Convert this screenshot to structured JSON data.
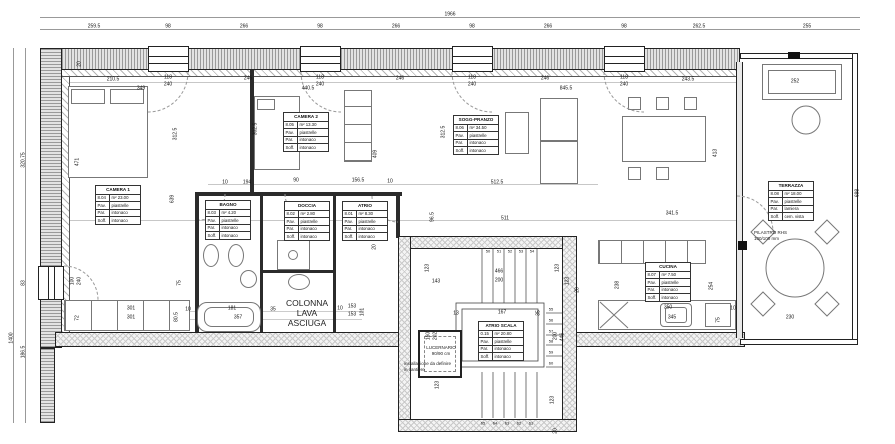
{
  "labels": {
    "m2": "m²",
    "pav": "Pav.",
    "par": "Par.",
    "soff": "Soff."
  },
  "colors": {
    "wall_line": "#222222",
    "hatch": "#9a9a9a",
    "dim_text": "#111111"
  },
  "rooms": [
    {
      "name": "CAMERA 1",
      "code": "8.04",
      "area": "23.00",
      "pav": "piastrelle",
      "par": "intonaco",
      "soff": "intonaco",
      "x": 95,
      "y": 185
    },
    {
      "name": "CAMERA 2",
      "code": "8.05",
      "area": "13.30",
      "pav": "piastrelle",
      "par": "intonaco",
      "soff": "intonaco",
      "x": 283,
      "y": 112
    },
    {
      "name": "BAGNO",
      "code": "8.03",
      "area": "4.20",
      "pav": "piastrelle",
      "par": "intonaco",
      "soff": "intonaco",
      "x": 205,
      "y": 200
    },
    {
      "name": "DOCCIA",
      "code": "8.02",
      "area": "2.80",
      "pav": "piastrelle",
      "par": "intonaco",
      "soff": "intonaco",
      "x": 284,
      "y": 201
    },
    {
      "name": "ATRIO",
      "code": "8.01",
      "area": "8.30",
      "pav": "piastrelle",
      "par": "intonaco",
      "soff": "intonaco",
      "x": 342,
      "y": 201
    },
    {
      "name": "SOGG-PRANZO",
      "code": "8.06",
      "area": "34.50",
      "pav": "piastrelle",
      "par": "intonaco",
      "soff": "intonaco",
      "x": 453,
      "y": 115
    },
    {
      "name": "CUCINA",
      "code": "8.07",
      "area": "7.50",
      "pav": "piastrelle",
      "par": "intonaco",
      "soff": "intonaco",
      "x": 645,
      "y": 262
    },
    {
      "name": "TERRAZZA",
      "code": "8.08",
      "area": "18.00",
      "pav": "piastrelle",
      "par": "lamiera",
      "soff": "cem. vista",
      "x": 768,
      "y": 181
    },
    {
      "name": "ATRIO SCALA",
      "code": "0.15",
      "area": "20.80",
      "pav": "piastrelle",
      "par": "intonaco",
      "soff": "intonaco",
      "x": 478,
      "y": 321
    }
  ],
  "notes": [
    {
      "lines": [
        "COLONNA",
        "LAVA",
        "ASCIUGA"
      ],
      "x": 307,
      "y": 313,
      "size": 8.5,
      "lh": 10,
      "align": "c"
    },
    {
      "lines": [
        "LUCERNARIO",
        "90/90 cm"
      ],
      "x": 441,
      "y": 351,
      "size": 4.5,
      "lh": 6,
      "align": "c"
    },
    {
      "lines": [
        "installazione da definire",
        "in cantiere"
      ],
      "x": 404,
      "y": 361,
      "size": 4.5,
      "lh": 6,
      "align": "l"
    },
    {
      "lines": [
        "PILASTRO RHS",
        "100/100 mm"
      ],
      "x": 754,
      "y": 230,
      "size": 4.5,
      "lh": 6,
      "align": "l"
    }
  ],
  "dims": [
    {
      "t": "1966",
      "x": 450,
      "y": 15
    },
    {
      "t": "259.5",
      "x": 94,
      "y": 27
    },
    {
      "t": "98",
      "x": 168,
      "y": 27
    },
    {
      "t": "266",
      "x": 244,
      "y": 27
    },
    {
      "t": "98",
      "x": 320,
      "y": 27
    },
    {
      "t": "266",
      "x": 396,
      "y": 27
    },
    {
      "t": "98",
      "x": 472,
      "y": 27
    },
    {
      "t": "266",
      "x": 548,
      "y": 27
    },
    {
      "t": "98",
      "x": 624,
      "y": 27
    },
    {
      "t": "262.5",
      "x": 699,
      "y": 27
    },
    {
      "t": "255",
      "x": 807,
      "y": 27
    },
    {
      "t": "320.75",
      "x": 24,
      "y": 160,
      "r": 1
    },
    {
      "t": "83",
      "x": 24,
      "y": 283,
      "r": 1
    },
    {
      "t": "1400",
      "x": 12,
      "y": 338,
      "r": 1
    },
    {
      "t": "186.5",
      "x": 24,
      "y": 352,
      "r": 1
    },
    {
      "t": "20",
      "x": 80,
      "y": 64,
      "r": 1
    },
    {
      "t": "210.5",
      "x": 113,
      "y": 80
    },
    {
      "t": "349",
      "x": 141,
      "y": 89
    },
    {
      "t": "118",
      "x": 168,
      "y": 78
    },
    {
      "t": "240",
      "x": 168,
      "y": 85
    },
    {
      "t": "246",
      "x": 248,
      "y": 79
    },
    {
      "t": "440.5",
      "x": 308,
      "y": 89
    },
    {
      "t": "118",
      "x": 320,
      "y": 78
    },
    {
      "t": "240",
      "x": 320,
      "y": 85
    },
    {
      "t": "246",
      "x": 400,
      "y": 79
    },
    {
      "t": "118",
      "x": 472,
      "y": 78
    },
    {
      "t": "240",
      "x": 472,
      "y": 85
    },
    {
      "t": "246",
      "x": 545,
      "y": 79
    },
    {
      "t": "845.5",
      "x": 566,
      "y": 89
    },
    {
      "t": "118",
      "x": 624,
      "y": 78
    },
    {
      "t": "240",
      "x": 624,
      "y": 85
    },
    {
      "t": "243.5",
      "x": 688,
      "y": 80
    },
    {
      "t": "252",
      "x": 795,
      "y": 82
    },
    {
      "t": "471",
      "x": 78,
      "y": 162,
      "r": 1
    },
    {
      "t": "312.5",
      "x": 176,
      "y": 134,
      "r": 1
    },
    {
      "t": "639",
      "x": 173,
      "y": 199,
      "r": 1
    },
    {
      "t": "302.5",
      "x": 256,
      "y": 129,
      "r": 1
    },
    {
      "t": "409",
      "x": 376,
      "y": 154,
      "r": 1
    },
    {
      "t": "312.5",
      "x": 444,
      "y": 132,
      "r": 1
    },
    {
      "t": "413",
      "x": 716,
      "y": 153,
      "r": 1
    },
    {
      "t": "698",
      "x": 858,
      "y": 193,
      "r": 1
    },
    {
      "t": "10",
      "x": 225,
      "y": 183
    },
    {
      "t": "194",
      "x": 247,
      "y": 183
    },
    {
      "t": "90",
      "x": 296,
      "y": 181
    },
    {
      "t": "156.5",
      "x": 358,
      "y": 181
    },
    {
      "t": "10",
      "x": 390,
      "y": 182
    },
    {
      "t": "811",
      "x": 220,
      "y": 219
    },
    {
      "t": "92",
      "x": 248,
      "y": 217,
      "r": 1
    },
    {
      "t": "96.5",
      "x": 433,
      "y": 217,
      "r": 1
    },
    {
      "t": "20",
      "x": 375,
      "y": 247,
      "r": 1
    },
    {
      "t": "512.5",
      "x": 497,
      "y": 183
    },
    {
      "t": "511",
      "x": 505,
      "y": 219
    },
    {
      "t": "341.5",
      "x": 672,
      "y": 214
    },
    {
      "t": "253.5",
      "x": 793,
      "y": 220
    },
    {
      "t": "230",
      "x": 790,
      "y": 318
    },
    {
      "t": "238",
      "x": 618,
      "y": 285,
      "r": 1
    },
    {
      "t": "254",
      "x": 712,
      "y": 286,
      "r": 1
    },
    {
      "t": "350",
      "x": 668,
      "y": 308
    },
    {
      "t": "345",
      "x": 672,
      "y": 318
    },
    {
      "t": "10",
      "x": 733,
      "y": 309
    },
    {
      "t": "75",
      "x": 719,
      "y": 320,
      "r": 1
    },
    {
      "t": "100",
      "x": 73,
      "y": 281,
      "r": 1
    },
    {
      "t": "240",
      "x": 80,
      "y": 281,
      "r": 1
    },
    {
      "t": "75",
      "x": 180,
      "y": 283,
      "r": 1
    },
    {
      "t": "301",
      "x": 131,
      "y": 309
    },
    {
      "t": "301",
      "x": 131,
      "y": 318
    },
    {
      "t": "72",
      "x": 78,
      "y": 318,
      "r": 1
    },
    {
      "t": "80.5",
      "x": 177,
      "y": 317,
      "r": 1
    },
    {
      "t": "10",
      "x": 188,
      "y": 310
    },
    {
      "t": "181",
      "x": 232,
      "y": 309
    },
    {
      "t": "357",
      "x": 238,
      "y": 318
    },
    {
      "t": "35",
      "x": 273,
      "y": 310
    },
    {
      "t": "10",
      "x": 340,
      "y": 309
    },
    {
      "t": "153",
      "x": 352,
      "y": 307
    },
    {
      "t": "153",
      "x": 352,
      "y": 315
    },
    {
      "t": "101",
      "x": 363,
      "y": 312,
      "r": 1
    },
    {
      "t": "143",
      "x": 436,
      "y": 282
    },
    {
      "t": "123",
      "x": 428,
      "y": 268,
      "r": 1
    },
    {
      "t": "466",
      "x": 499,
      "y": 272
    },
    {
      "t": "200",
      "x": 499,
      "y": 281
    },
    {
      "t": "123",
      "x": 558,
      "y": 268,
      "r": 1
    },
    {
      "t": "123",
      "x": 568,
      "y": 281,
      "r": 1
    },
    {
      "t": "28",
      "x": 578,
      "y": 290,
      "r": 1
    },
    {
      "t": "13",
      "x": 456,
      "y": 314
    },
    {
      "t": "167",
      "x": 502,
      "y": 313
    },
    {
      "t": "35",
      "x": 539,
      "y": 313,
      "r": 1
    },
    {
      "t": "160",
      "x": 429,
      "y": 336,
      "r": 1
    },
    {
      "t": "202",
      "x": 436,
      "y": 336,
      "r": 1
    },
    {
      "t": "200",
      "x": 556,
      "y": 336,
      "r": 1
    },
    {
      "t": "446",
      "x": 563,
      "y": 337,
      "r": 1
    },
    {
      "t": "123",
      "x": 438,
      "y": 385,
      "r": 1
    },
    {
      "t": "123",
      "x": 553,
      "y": 400,
      "r": 1
    },
    {
      "t": "20",
      "x": 556,
      "y": 431,
      "r": 1
    },
    {
      "t": "50",
      "x": 488,
      "y": 251,
      "s": 4
    },
    {
      "t": "51",
      "x": 499,
      "y": 251,
      "s": 4
    },
    {
      "t": "52",
      "x": 510,
      "y": 251,
      "s": 4
    },
    {
      "t": "53",
      "x": 521,
      "y": 251,
      "s": 4
    },
    {
      "t": "54",
      "x": 532,
      "y": 251,
      "s": 4
    },
    {
      "t": "55",
      "x": 551,
      "y": 309,
      "s": 4
    },
    {
      "t": "56",
      "x": 551,
      "y": 320,
      "s": 4
    },
    {
      "t": "57",
      "x": 551,
      "y": 331,
      "s": 4
    },
    {
      "t": "58",
      "x": 551,
      "y": 341,
      "s": 4
    },
    {
      "t": "59",
      "x": 551,
      "y": 352,
      "s": 4
    },
    {
      "t": "60",
      "x": 551,
      "y": 363,
      "s": 4
    },
    {
      "t": "65",
      "x": 483,
      "y": 423,
      "s": 4
    },
    {
      "t": "64",
      "x": 495,
      "y": 423,
      "s": 4
    },
    {
      "t": "63",
      "x": 507,
      "y": 423,
      "s": 4
    },
    {
      "t": "62",
      "x": 519,
      "y": 423,
      "s": 4
    },
    {
      "t": "61",
      "x": 531,
      "y": 423,
      "s": 4
    }
  ]
}
